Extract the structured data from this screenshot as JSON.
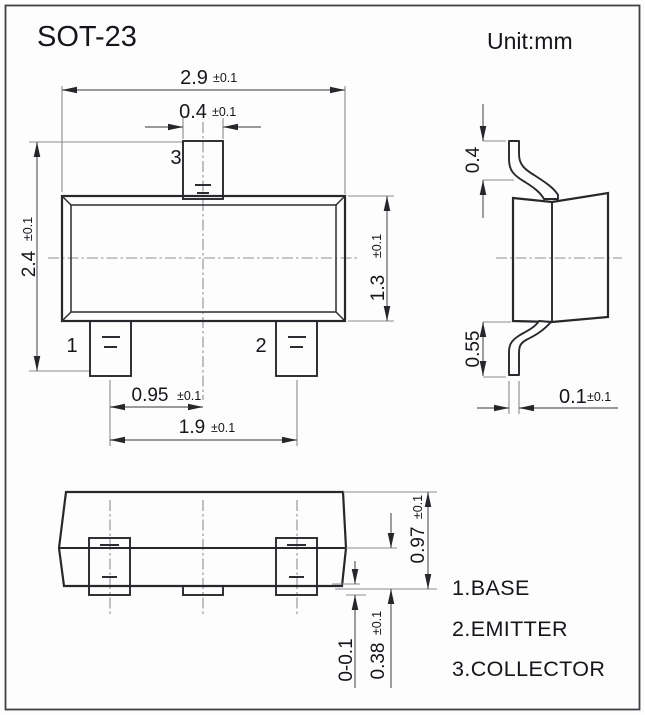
{
  "title": "SOT-23",
  "unit_label": "Unit:mm",
  "dims": {
    "body_width": {
      "v": "2.9",
      "t": "±0.1"
    },
    "pin3_width": {
      "v": "0.4",
      "t": "±0.1"
    },
    "total_height": {
      "v": "2.4",
      "t": "±0.1"
    },
    "body_height": {
      "v": "1.3",
      "t": "±0.1"
    },
    "pin_pitch": {
      "v": "0.95",
      "t": "±0.1"
    },
    "pin_span": {
      "v": "1.9",
      "t": "±0.1"
    },
    "lead_top": {
      "v": "0.4"
    },
    "lead_bottom": {
      "v": "0.55"
    },
    "lead_thickness": {
      "v": "0.1",
      "t": "±0.1"
    },
    "body_thickness": {
      "v": "0.97",
      "t": "±0.1"
    },
    "standoff": {
      "v": "0.38",
      "t": "±0.1"
    },
    "lead_protrusion": {
      "v": "0-0.1"
    }
  },
  "pins": {
    "p1": "1",
    "p2": "2",
    "p3": "3"
  },
  "legend": [
    "1.BASE",
    "2.EMITTER",
    "3.COLLECTOR"
  ]
}
